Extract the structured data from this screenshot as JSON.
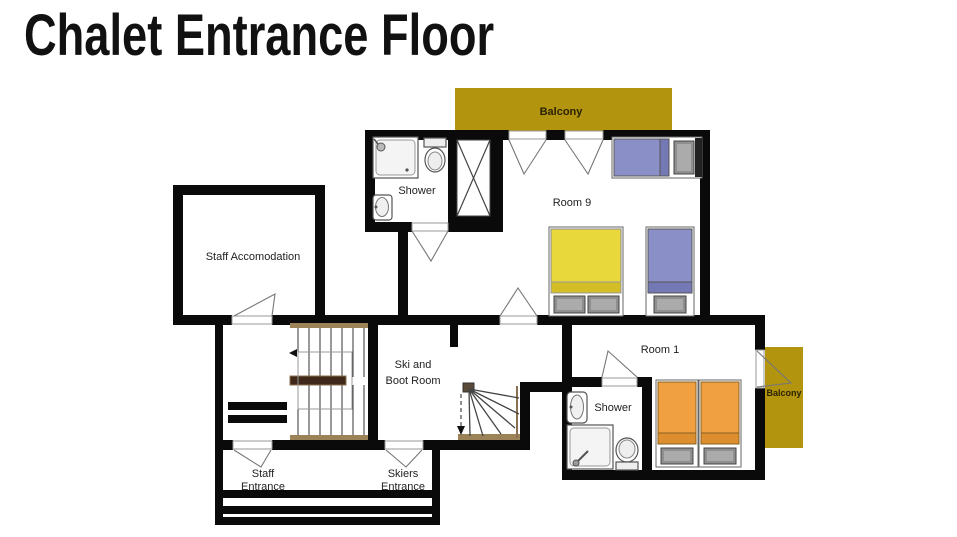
{
  "title": "Chalet Entrance Floor",
  "plan": {
    "balconies": {
      "top": "Balcony",
      "right": "Balcony"
    },
    "rooms": {
      "room9": "Room 9",
      "room1": "Room 1",
      "staff_accommodation": "Staff Accomodation",
      "ski_boot_line1": "Ski and",
      "ski_boot_line2": "Boot Room",
      "shower_top": "Shower",
      "shower_room1": "Shower"
    },
    "entrances": {
      "staff_line1": "Staff",
      "staff_line2": "Entrance",
      "skiers_line1": "Skiers",
      "skiers_line2": "Entrance"
    }
  },
  "colors": {
    "wall": "#0a0a0a",
    "balcony": "#b2940e",
    "bed_blue": "#8a8fc8",
    "bed_blue_band": "#7478b4",
    "bed_yellow": "#e9d83b",
    "bed_yellow_band": "#d4be25",
    "bed_orange": "#f0a041",
    "bed_orange_band": "#dd8f2f",
    "pillow": "#8f8f8f",
    "stair_landing": "#40291a",
    "stair_edge": "#9c8257"
  }
}
